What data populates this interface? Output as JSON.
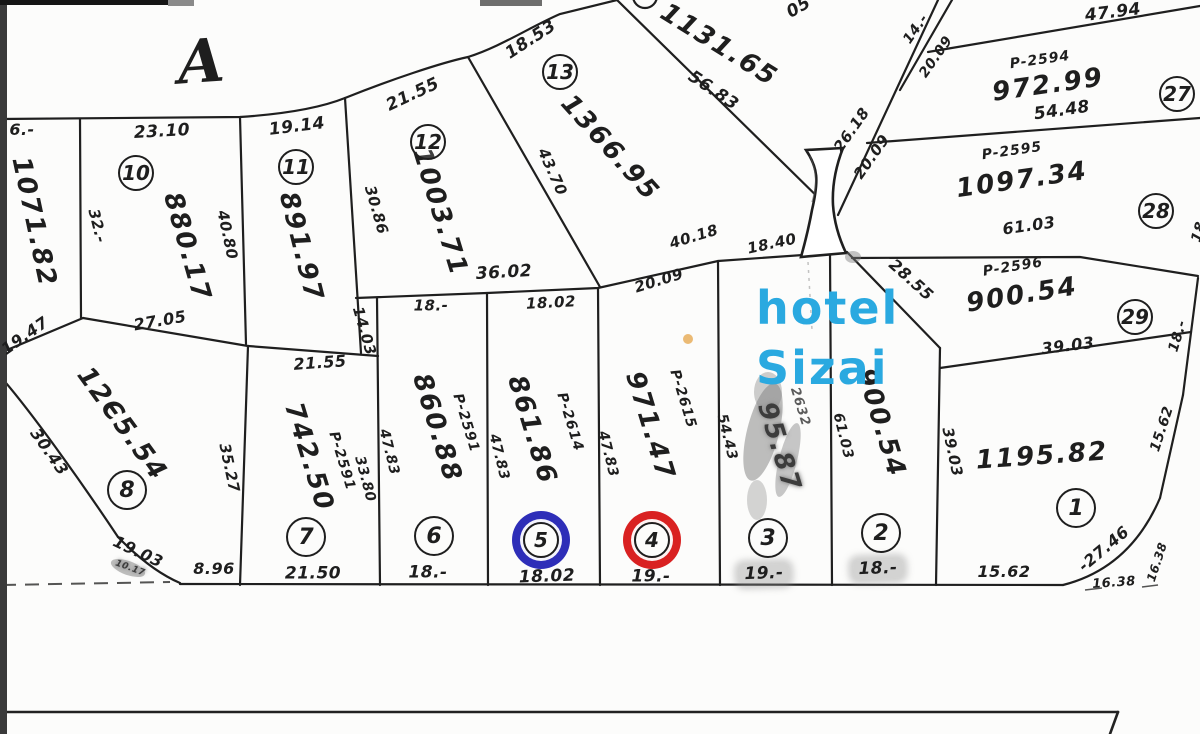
{
  "map": {
    "section_letter": "A",
    "hotel_label": {
      "line1": "hotel",
      "line2": "Sizai"
    },
    "colors": {
      "ink": "#1e1e1e",
      "hotel_blue": "#2aa9e0",
      "ring_blue": "#2e2eb8",
      "ring_red": "#d92121",
      "orange_dot": "#e9b365"
    },
    "parcel_markers": [
      {
        "n": "10",
        "x": 136,
        "y": 173,
        "r": 16
      },
      {
        "n": "11",
        "x": 296,
        "y": 167,
        "r": 16
      },
      {
        "n": "12",
        "x": 428,
        "y": 142,
        "r": 16
      },
      {
        "n": "13",
        "x": 560,
        "y": 72,
        "r": 16
      },
      {
        "n": "8",
        "x": 127,
        "y": 490,
        "r": 18
      },
      {
        "n": "7",
        "x": 306,
        "y": 537,
        "r": 18
      },
      {
        "n": "6",
        "x": 434,
        "y": 536,
        "r": 18
      },
      {
        "n": "5",
        "x": 541,
        "y": 540,
        "r": 16,
        "ring": "blue"
      },
      {
        "n": "4",
        "x": 652,
        "y": 540,
        "r": 16,
        "ring": "red"
      },
      {
        "n": "3",
        "x": 768,
        "y": 538,
        "r": 18
      },
      {
        "n": "2",
        "x": 881,
        "y": 533,
        "r": 18
      },
      {
        "n": "1",
        "x": 1076,
        "y": 508,
        "r": 18
      },
      {
        "n": "27",
        "x": 1177,
        "y": 94,
        "r": 16
      },
      {
        "n": "28",
        "x": 1156,
        "y": 211,
        "r": 16
      },
      {
        "n": "29",
        "x": 1135,
        "y": 317,
        "r": 16
      }
    ],
    "labels": [
      {
        "name": "section-letter",
        "text": "A",
        "x": 201,
        "y": 62,
        "rot": -4,
        "size": 60,
        "cls": "big"
      },
      {
        "name": "dim-6-cut",
        "text": "6.-",
        "x": 22,
        "y": 130,
        "rot": 0,
        "size": 16
      },
      {
        "name": "dim-2310",
        "text": "23.10",
        "x": 162,
        "y": 132,
        "rot": -3,
        "size": 17
      },
      {
        "name": "dim-1914",
        "text": "19.14",
        "x": 297,
        "y": 127,
        "rot": -7,
        "size": 17
      },
      {
        "name": "dim-32",
        "text": "32.-",
        "x": 97,
        "y": 226,
        "rot": 76,
        "size": 15
      },
      {
        "name": "area-880-17",
        "text": "880.17",
        "x": 187,
        "y": 247,
        "rot": 74,
        "size": 26,
        "cls": "area"
      },
      {
        "name": "dim-4080",
        "text": "40.80",
        "x": 227,
        "y": 235,
        "rot": 78,
        "size": 15
      },
      {
        "name": "area-1071-82",
        "text": "1071.82",
        "x": 34,
        "y": 222,
        "rot": 78,
        "size": 26,
        "cls": "area"
      },
      {
        "name": "area-891-97",
        "text": "891.97",
        "x": 301,
        "y": 247,
        "rot": 76,
        "size": 26,
        "cls": "area"
      },
      {
        "name": "dim-3086",
        "text": "30.86",
        "x": 376,
        "y": 210,
        "rot": 74,
        "size": 15
      },
      {
        "name": "dim-2155-arc",
        "text": "21.55",
        "x": 413,
        "y": 95,
        "rot": -25,
        "size": 17
      },
      {
        "name": "dim-1853",
        "text": "18.53",
        "x": 531,
        "y": 40,
        "rot": -33,
        "size": 17
      },
      {
        "name": "area-1003-71",
        "text": "1003.71",
        "x": 440,
        "y": 212,
        "rot": 73,
        "size": 26,
        "cls": "area"
      },
      {
        "name": "dim-4370",
        "text": "43.70",
        "x": 552,
        "y": 172,
        "rot": 66,
        "size": 15
      },
      {
        "name": "area-1366-95",
        "text": "1366.95",
        "x": 610,
        "y": 148,
        "rot": 48,
        "size": 26,
        "cls": "area"
      },
      {
        "name": "dim-5683",
        "text": "56.83",
        "x": 713,
        "y": 91,
        "rot": 34,
        "size": 17
      },
      {
        "name": "area-1131-65",
        "text": "1131.65",
        "x": 719,
        "y": 45,
        "rot": 32,
        "size": 26,
        "cls": "area"
      },
      {
        "name": "dim-05-cut",
        "text": "05",
        "x": 799,
        "y": 8,
        "rot": -30,
        "size": 17
      },
      {
        "name": "dim-3602",
        "text": "36.02",
        "x": 504,
        "y": 273,
        "rot": -3,
        "size": 17
      },
      {
        "name": "dim-18-p6top",
        "text": "18.-",
        "x": 431,
        "y": 306,
        "rot": 0,
        "size": 15
      },
      {
        "name": "dim-1802-p5top",
        "text": "18.02",
        "x": 551,
        "y": 303,
        "rot": -3,
        "size": 15
      },
      {
        "name": "dim-2009-slope",
        "text": "20.09",
        "x": 659,
        "y": 281,
        "rot": -17,
        "size": 15
      },
      {
        "name": "dim-4018",
        "text": "40.18",
        "x": 694,
        "y": 237,
        "rot": -17,
        "size": 15
      },
      {
        "name": "dim-1840",
        "text": "18.40",
        "x": 772,
        "y": 244,
        "rot": -12,
        "size": 15
      },
      {
        "name": "dim-2618",
        "text": "26.18",
        "x": 852,
        "y": 130,
        "rot": -55,
        "size": 15
      },
      {
        "name": "dim-2009-diag",
        "text": "20.09",
        "x": 872,
        "y": 157,
        "rot": -55,
        "size": 15
      },
      {
        "name": "dim-14",
        "text": "14.-",
        "x": 916,
        "y": 29,
        "rot": -55,
        "size": 14
      },
      {
        "name": "dim-2009-top",
        "text": "20.09",
        "x": 936,
        "y": 57,
        "rot": -55,
        "size": 14
      },
      {
        "name": "dim-4794",
        "text": "47.94",
        "x": 1113,
        "y": 13,
        "rot": -7,
        "size": 17
      },
      {
        "name": "pnum-2594",
        "text": "P-2594",
        "x": 1040,
        "y": 60,
        "rot": -8,
        "size": 14,
        "cls": "pnum"
      },
      {
        "name": "area-972-99",
        "text": "972.99",
        "x": 1048,
        "y": 85,
        "rot": -8,
        "size": 26,
        "cls": "area"
      },
      {
        "name": "dim-5448",
        "text": "54.48",
        "x": 1062,
        "y": 111,
        "rot": -8,
        "size": 17
      },
      {
        "name": "pnum-2595",
        "text": "P-2595",
        "x": 1012,
        "y": 151,
        "rot": -8,
        "size": 14,
        "cls": "pnum"
      },
      {
        "name": "area-1097-34",
        "text": "1097.34",
        "x": 1022,
        "y": 180,
        "rot": -8,
        "size": 26,
        "cls": "area"
      },
      {
        "name": "dim-6103-right",
        "text": "61.03",
        "x": 1029,
        "y": 226,
        "rot": -8,
        "size": 16
      },
      {
        "name": "pnum-2596",
        "text": "P-2596",
        "x": 1013,
        "y": 267,
        "rot": -9,
        "size": 14,
        "cls": "pnum"
      },
      {
        "name": "area-900-54-right",
        "text": "900.54",
        "x": 1022,
        "y": 295,
        "rot": -9,
        "size": 26,
        "cls": "area"
      },
      {
        "name": "dim-2855",
        "text": "28.55",
        "x": 911,
        "y": 280,
        "rot": 42,
        "size": 16
      },
      {
        "name": "dim-3903-right",
        "text": "39.03",
        "x": 1068,
        "y": 346,
        "rot": -7,
        "size": 16
      },
      {
        "name": "dim-18-redge",
        "text": "18.-",
        "x": 1178,
        "y": 336,
        "rot": -73,
        "size": 14
      },
      {
        "name": "dim-cut-right",
        "text": "18",
        "x": 1199,
        "y": 232,
        "rot": -73,
        "size": 14
      },
      {
        "name": "area-1195-82",
        "text": "1195.82",
        "x": 1042,
        "y": 456,
        "rot": -4,
        "size": 26,
        "cls": "area"
      },
      {
        "name": "dim-3903-p1",
        "text": "39.03",
        "x": 952,
        "y": 452,
        "rot": 78,
        "size": 15
      },
      {
        "name": "dim-1562-redge",
        "text": "15.62",
        "x": 1162,
        "y": 429,
        "rot": -72,
        "size": 14
      },
      {
        "name": "dim-1947",
        "text": "19.47",
        "x": 25,
        "y": 336,
        "rot": -35,
        "size": 16
      },
      {
        "name": "dim-2705",
        "text": "27.05",
        "x": 160,
        "y": 321,
        "rot": -10,
        "size": 16
      },
      {
        "name": "area-1205-54",
        "text": "12Є5.54",
        "x": 122,
        "y": 424,
        "rot": 54,
        "size": 26,
        "cls": "area"
      },
      {
        "name": "dim-3043",
        "text": "30.43",
        "x": 49,
        "y": 452,
        "rot": 55,
        "size": 16
      },
      {
        "name": "dim-3527",
        "text": "35.27",
        "x": 229,
        "y": 468,
        "rot": 78,
        "size": 15
      },
      {
        "name": "dim-2155-p7",
        "text": "21.55",
        "x": 320,
        "y": 363,
        "rot": -4,
        "size": 16
      },
      {
        "name": "dim-1403",
        "text": "14.03",
        "x": 364,
        "y": 331,
        "rot": 74,
        "size": 15
      },
      {
        "name": "area-742-50",
        "text": "742.50",
        "x": 309,
        "y": 457,
        "rot": 73,
        "size": 26,
        "cls": "area"
      },
      {
        "name": "pnum-2591-p7",
        "text": "P-2591",
        "x": 342,
        "y": 461,
        "rot": 73,
        "size": 14,
        "cls": "pnum"
      },
      {
        "name": "dim-3380",
        "text": "33.80",
        "x": 365,
        "y": 479,
        "rot": 75,
        "size": 14
      },
      {
        "name": "dim-4783-a",
        "text": "47.83",
        "x": 389,
        "y": 452,
        "rot": 76,
        "size": 14
      },
      {
        "name": "area-860-88",
        "text": "860.88",
        "x": 437,
        "y": 428,
        "rot": 73,
        "size": 26,
        "cls": "area"
      },
      {
        "name": "pnum-2591-p6",
        "text": "P-2591",
        "x": 466,
        "y": 423,
        "rot": 73,
        "size": 14,
        "cls": "pnum"
      },
      {
        "name": "dim-4783-b",
        "text": "47.83",
        "x": 499,
        "y": 457,
        "rot": 76,
        "size": 14
      },
      {
        "name": "area-861-86",
        "text": "861.86",
        "x": 532,
        "y": 430,
        "rot": 73,
        "size": 26,
        "cls": "area"
      },
      {
        "name": "pnum-2614",
        "text": "P-2614",
        "x": 570,
        "y": 422,
        "rot": 73,
        "size": 14,
        "cls": "pnum"
      },
      {
        "name": "dim-4783-c",
        "text": "47.83",
        "x": 608,
        "y": 454,
        "rot": 76,
        "size": 14
      },
      {
        "name": "area-971-47",
        "text": "971.47",
        "x": 650,
        "y": 426,
        "rot": 73,
        "size": 26,
        "cls": "area"
      },
      {
        "name": "pnum-2615",
        "text": "P-2615",
        "x": 683,
        "y": 399,
        "rot": 73,
        "size": 14,
        "cls": "pnum"
      },
      {
        "name": "dim-5443",
        "text": "54.43",
        "x": 727,
        "y": 437,
        "rot": 76,
        "size": 14
      },
      {
        "name": "area-95-87",
        "text": "95.87",
        "x": 779,
        "y": 447,
        "rot": 73,
        "size": 26,
        "cls": "area smudged"
      },
      {
        "name": "num-2632",
        "text": "2632",
        "x": 800,
        "y": 407,
        "rot": 73,
        "size": 13,
        "cls": "pnum faded"
      },
      {
        "name": "area-900-54-p2",
        "text": "900.54",
        "x": 881,
        "y": 423,
        "rot": 73,
        "size": 26,
        "cls": "area"
      },
      {
        "name": "dim-6103-p2",
        "text": "61.03",
        "x": 843,
        "y": 436,
        "rot": 76,
        "size": 14
      },
      {
        "name": "dim-1903",
        "text": "19.03",
        "x": 138,
        "y": 552,
        "rot": 25,
        "size": 16
      },
      {
        "name": "smudge-1017",
        "text": "10.17",
        "x": 130,
        "y": 569,
        "rot": 20,
        "size": 9,
        "cls": "smudged"
      },
      {
        "name": "dim-896",
        "text": "8.96",
        "x": 214,
        "y": 569,
        "rot": 0,
        "size": 16
      },
      {
        "name": "dim-2150",
        "text": "21.50",
        "x": 313,
        "y": 574,
        "rot": 0,
        "size": 17
      },
      {
        "name": "dim-18-p6bot",
        "text": "18.-",
        "x": 428,
        "y": 573,
        "rot": 0,
        "size": 17
      },
      {
        "name": "dim-1802-p5bot",
        "text": "18.02",
        "x": 547,
        "y": 577,
        "rot": -2,
        "size": 17
      },
      {
        "name": "dim-19-p4bot",
        "text": "19.-",
        "x": 651,
        "y": 577,
        "rot": 0,
        "size": 17
      },
      {
        "name": "dim-19-p3bot",
        "text": "19.-",
        "x": 764,
        "y": 574,
        "rot": -2,
        "size": 17,
        "cls": "smudge-bg"
      },
      {
        "name": "dim-18-p2bot",
        "text": "18.-",
        "x": 878,
        "y": 569,
        "rot": -2,
        "size": 17,
        "cls": "smudge-bg"
      },
      {
        "name": "dim-1562-bot",
        "text": "15.62",
        "x": 1004,
        "y": 572,
        "rot": 0,
        "size": 16
      },
      {
        "name": "dim-2746",
        "text": "-27.46",
        "x": 1104,
        "y": 549,
        "rot": -40,
        "size": 16
      },
      {
        "name": "dim-1638-bot",
        "text": "16.38",
        "x": 1114,
        "y": 583,
        "rot": -4,
        "size": 13
      },
      {
        "name": "dim-1638-redge",
        "text": "16.38",
        "x": 1157,
        "y": 562,
        "rot": -72,
        "size": 12
      }
    ]
  }
}
